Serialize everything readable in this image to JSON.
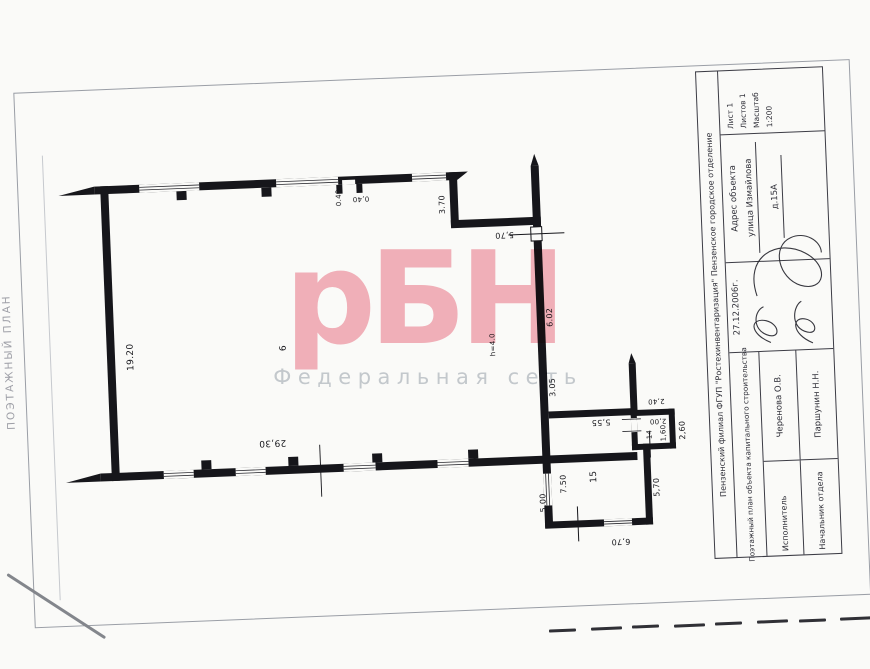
{
  "side_text": "ПОЭТАЖНЫЙ ПЛАН",
  "watermark": {
    "main": "рБН",
    "sub": "Федеральная сеть",
    "main_color": "#f5b3bd",
    "sub_color": "#c7ccd2"
  },
  "title_block": {
    "org": "Пензенский филиал ФГУП \"Ростехинвентаризация\" Пензенское городское отделение",
    "doc_type": "Поэтажный план объекта капитального строительства",
    "date": "27.12.2006г.",
    "executor_label": "Исполнитель",
    "executor_name": "Черенова О.В.",
    "head_label": "Начальник отдела",
    "head_name": "Паршунин Н.Н.",
    "address_label": "Адрес объекта",
    "address_street": "улица Измайлова",
    "address_house": "д.15А",
    "sheet_label": "Лист 1",
    "sheets_label": "Листов 1",
    "scale_label": "Масштаб",
    "scale_value": "1:200"
  },
  "plan": {
    "ink_color": "#16161b",
    "labels": [
      {
        "text": "19.20",
        "x": 130,
        "y": 345,
        "rot": -90,
        "size": 9
      },
      {
        "text": "29,30",
        "x": 268,
        "y": 436,
        "rot": 180,
        "size": 9
      },
      {
        "text": "6",
        "x": 283,
        "y": 342,
        "rot": -90,
        "size": 9
      },
      {
        "text": "0.40",
        "x": 344,
        "y": 194,
        "rot": -90,
        "size": 7
      },
      {
        "text": "0,40",
        "x": 366,
        "y": 196,
        "rot": 180,
        "size": 7
      },
      {
        "text": "3.70",
        "x": 447,
        "y": 205,
        "rot": -90,
        "size": 8
      },
      {
        "text": "5,70",
        "x": 508,
        "y": 238,
        "rot": 180,
        "size": 8
      },
      {
        "text": "6.02",
        "x": 550,
        "y": 322,
        "rot": -90,
        "size": 8
      },
      {
        "text": "h=4.0",
        "x": 492,
        "y": 347,
        "rot": -90,
        "size": 7
      },
      {
        "text": "3.05",
        "x": 550,
        "y": 392,
        "rot": -90,
        "size": 8
      },
      {
        "text": "5,55",
        "x": 597,
        "y": 429,
        "rot": 180,
        "size": 8
      },
      {
        "text": "2,40",
        "x": 653,
        "y": 410,
        "rot": 180,
        "size": 7
      },
      {
        "text": "2,00",
        "x": 654,
        "y": 430,
        "rot": 180,
        "size": 7
      },
      {
        "text": "14",
        "x": 645,
        "y": 443,
        "rot": -90,
        "size": 7
      },
      {
        "text": "1,60",
        "x": 659,
        "y": 442,
        "rot": -90,
        "size": 7
      },
      {
        "text": "2,60",
        "x": 678,
        "y": 440,
        "rot": -90,
        "size": 8
      },
      {
        "text": "7.50",
        "x": 557,
        "y": 489,
        "rot": -90,
        "size": 8
      },
      {
        "text": "5.00",
        "x": 536,
        "y": 507,
        "rot": -90,
        "size": 8
      },
      {
        "text": "15",
        "x": 588,
        "y": 483,
        "rot": -90,
        "size": 9
      },
      {
        "text": "5,70",
        "x": 650,
        "y": 496,
        "rot": -90,
        "size": 8
      },
      {
        "text": "6,70",
        "x": 612,
        "y": 549,
        "rot": 180,
        "size": 8
      }
    ]
  },
  "bottom_marks": {
    "count": 8
  }
}
